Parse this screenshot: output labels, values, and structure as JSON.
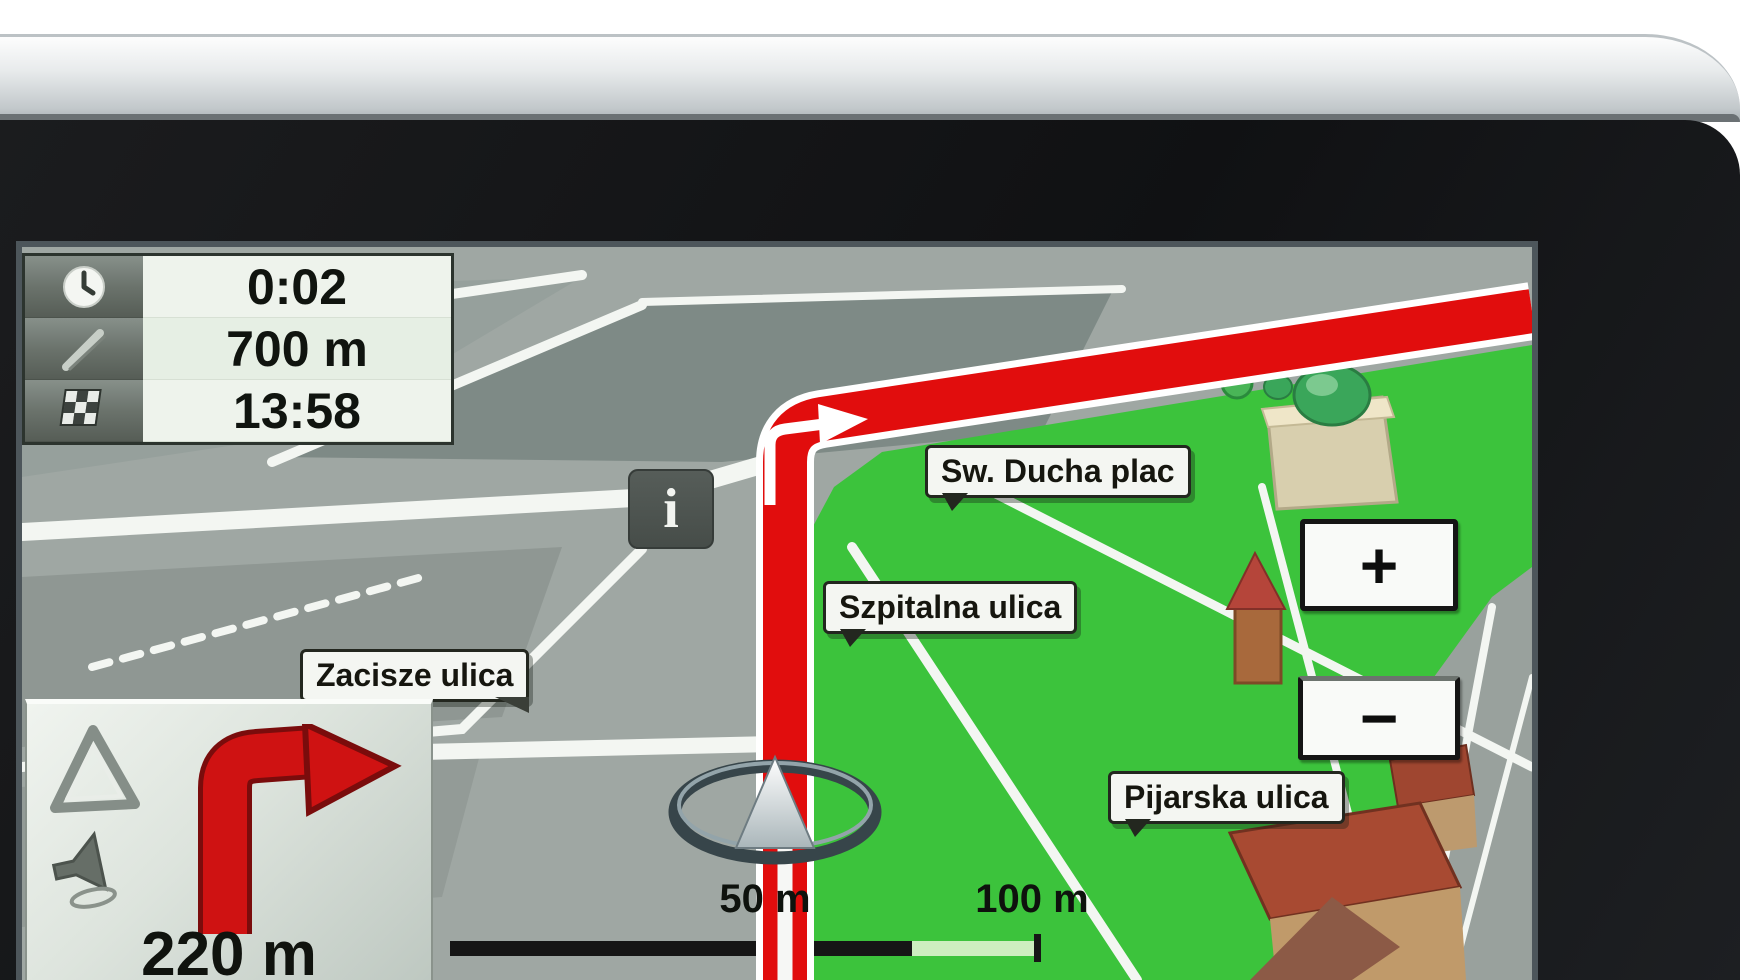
{
  "screen": {
    "type": "gps-navigation-map-view"
  },
  "trip_panel": {
    "rows": [
      {
        "icon": "clock-icon",
        "value": "0:02"
      },
      {
        "icon": "route-distance-icon",
        "value": "700 m"
      },
      {
        "icon": "finish-flag-icon",
        "value": "13:58"
      }
    ]
  },
  "maneuver_panel": {
    "maneuver": "turn-right",
    "distance": "220 m"
  },
  "map": {
    "street_labels": [
      {
        "name": "sw-ducha-plac",
        "text": "Sw. Ducha plac"
      },
      {
        "name": "szpitalna-ulica",
        "text": "Szpitalna ulica"
      },
      {
        "name": "zacisze-ulica",
        "text": "Zacisze ulica"
      },
      {
        "name": "pijarska-ulica",
        "text": "Pijarska ulica"
      }
    ],
    "info_button": "i",
    "zoom_in_label": "+",
    "zoom_out_label": "−",
    "scale_labels": [
      "50 m",
      "100 m"
    ],
    "colors": {
      "route": "#dd0f0f",
      "park_green": "#3cc33c",
      "city_gray": "#9fa7a3",
      "road_white": "#f3f6f2"
    }
  }
}
